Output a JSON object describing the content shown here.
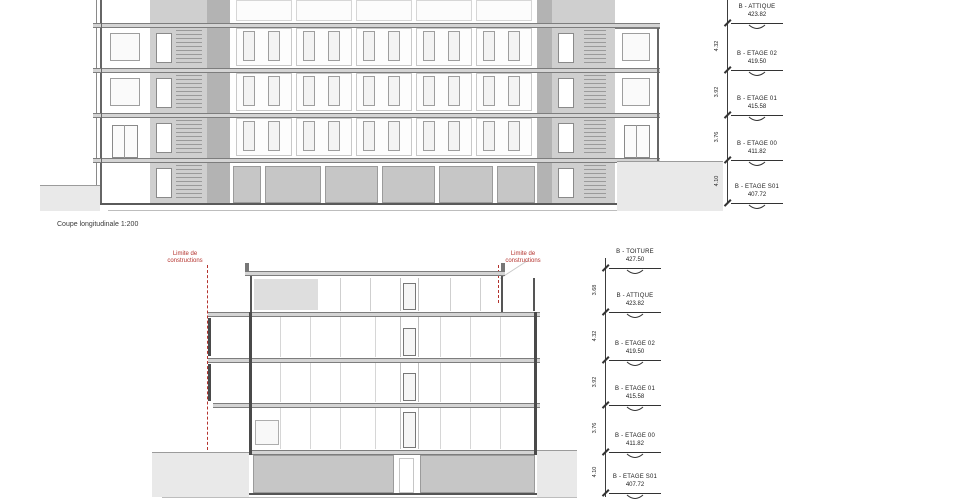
{
  "caption": "Coupe longitudinale 1:200",
  "colors": {
    "annotation_red": "#b4332e",
    "cut_wall_gray": "#b3b3b3",
    "core_gray": "#cfcfcf",
    "slab_gray": "#d4d4d4",
    "garage_gray": "#c6c6c6",
    "terrain_gray": "#e9e9e9",
    "line_dark": "#3c3c3c"
  },
  "construction_limit": {
    "line1": "Limite de",
    "line2": "constructions"
  },
  "top_section": {
    "levels": [
      {
        "name": "B - ATTIQUE",
        "value": "423.82"
      },
      {
        "name": "B - ETAGE 02",
        "value": "419.50"
      },
      {
        "name": "B - ETAGE 01",
        "value": "415.58"
      },
      {
        "name": "B - ETAGE 00",
        "value": "411.82"
      },
      {
        "name": "B - ETAGE S01",
        "value": "407.72"
      }
    ],
    "interlevel_dimensions": [
      "4.32",
      "3.92",
      "3.76",
      "4.10"
    ]
  },
  "bottom_section": {
    "levels": [
      {
        "name": "B - TOITURE",
        "value": "427.50"
      },
      {
        "name": "B - ATTIQUE",
        "value": "423.82"
      },
      {
        "name": "B - ETAGE 02",
        "value": "419.50"
      },
      {
        "name": "B - ETAGE 01",
        "value": "415.58"
      },
      {
        "name": "B - ETAGE 00",
        "value": "411.82"
      },
      {
        "name": "B - ETAGE S01",
        "value": "407.72"
      }
    ],
    "interlevel_dimensions": [
      "3.68",
      "4.32",
      "3.92",
      "3.76",
      "4.10"
    ]
  }
}
